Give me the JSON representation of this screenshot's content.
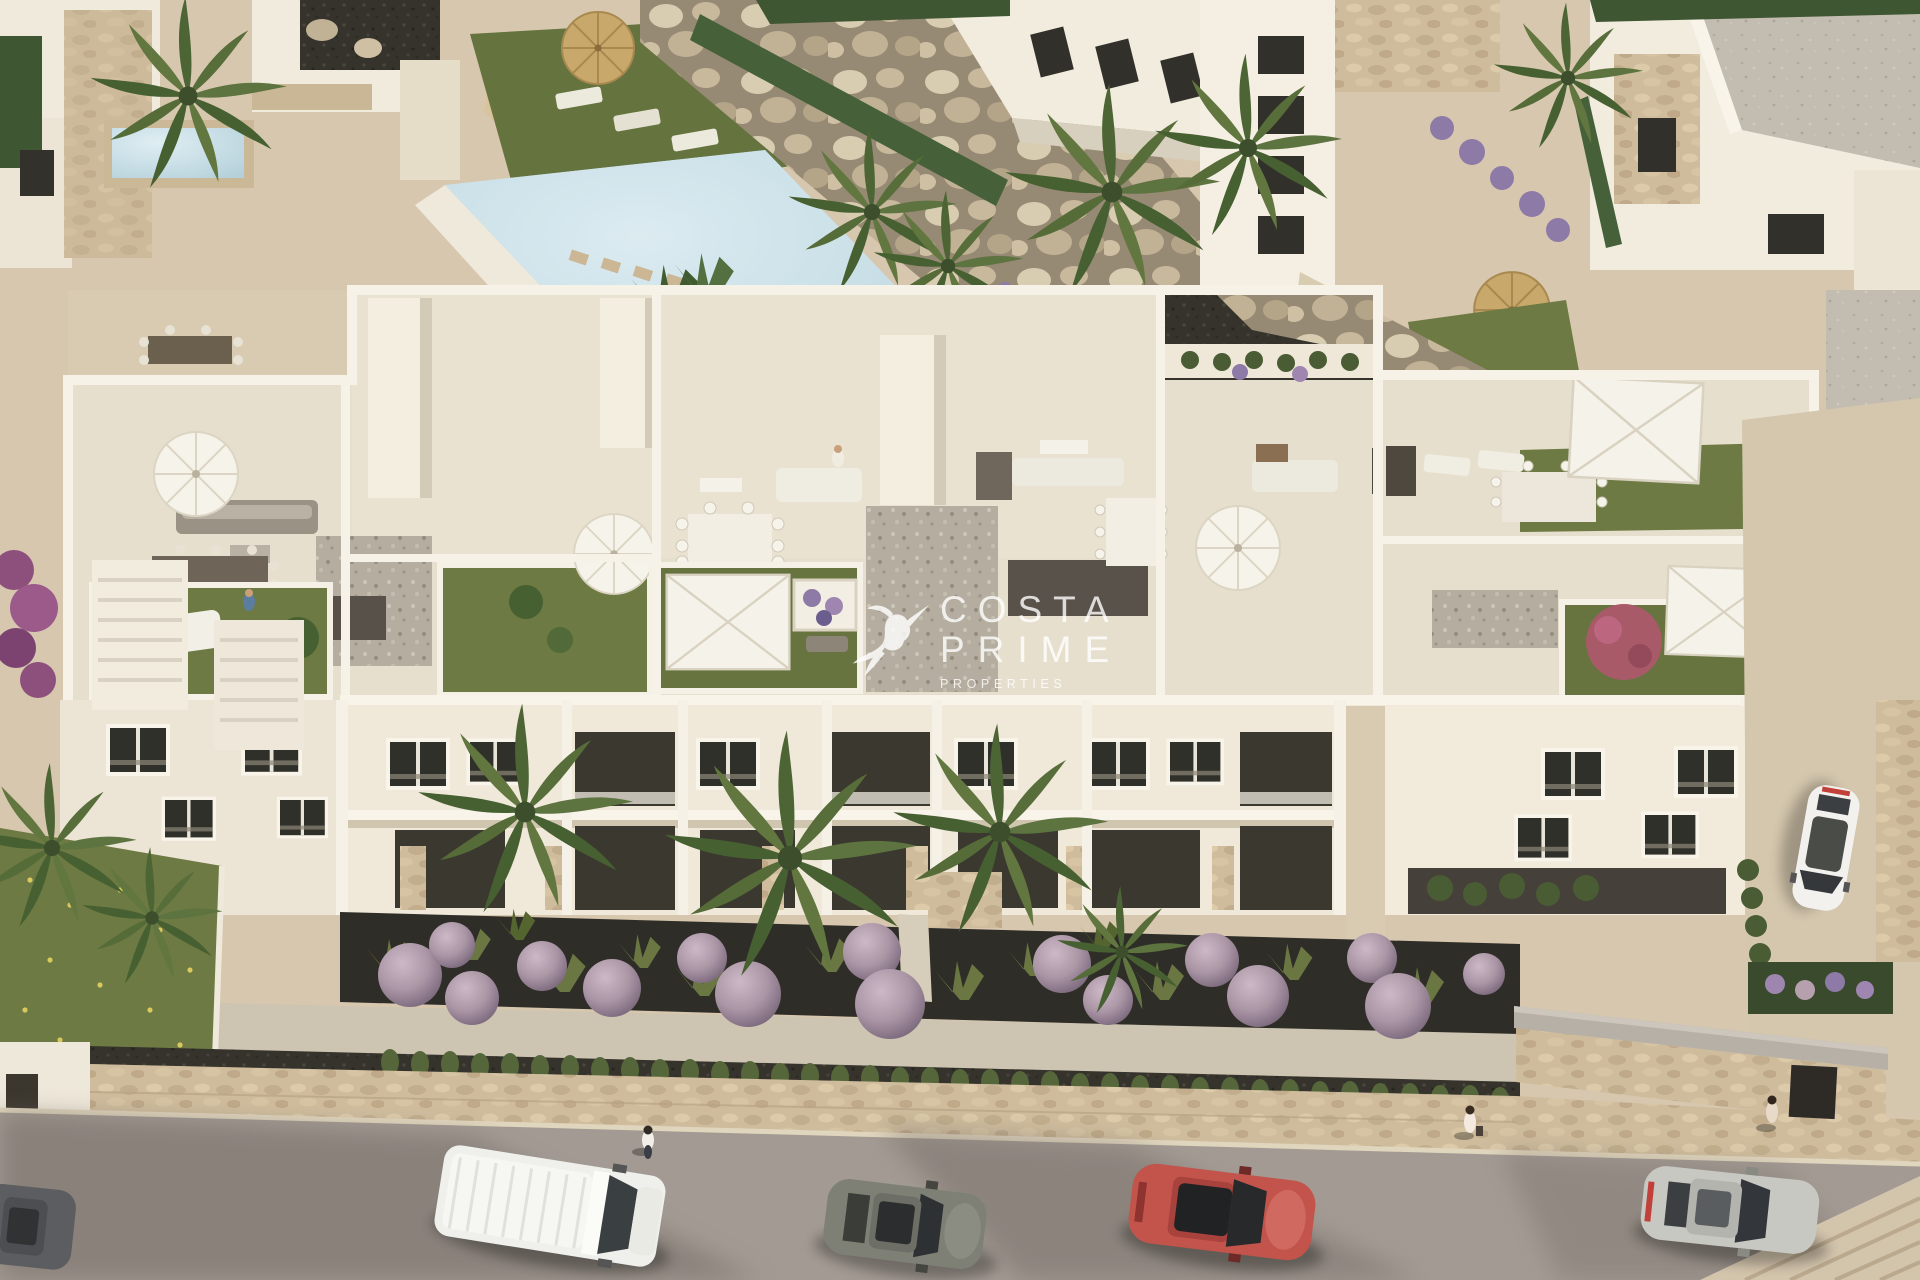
{
  "watermark": {
    "logo_icon": "hummingbird-icon",
    "line1": "COSTA",
    "line2": "PRIME",
    "line3": "PROPERTIES",
    "color": "#ffffff",
    "opacity": 0.8
  },
  "scene": {
    "type": "aerial-architectural-render",
    "palette": {
      "paving": "#d6c7ae",
      "building_white": "#f2ecdf",
      "terrace_floor": "#e7dfcd",
      "lawn": "#6d7a43",
      "road": "#a39b93",
      "soil": "#2f2d27",
      "stone": "#c9b795",
      "hedge": "#4a5c33",
      "pool": "#c6dde6",
      "mauve_bush": "#b7a0ae"
    },
    "pool": {
      "color": "#c6dde6"
    },
    "vehicles": [
      {
        "name": "white-van-street",
        "color": "#eff0ec"
      },
      {
        "name": "gray-hatchback-street",
        "color": "#7e8076"
      },
      {
        "name": "red-hatchback-street",
        "color": "#c2544c"
      },
      {
        "name": "silver-hatchback-street",
        "color": "#c8c8c3"
      },
      {
        "name": "white-car-driveway",
        "color": "#f2f1ee"
      },
      {
        "name": "dark-car-left-edge",
        "color": "#5b5d60"
      }
    ],
    "pedestrians": 5,
    "rooftop_amenities": [
      "round-parasols",
      "square-canopies",
      "outdoor-sofas",
      "dining-sets",
      "sun-loungers",
      "lawn-patches",
      "gravel-courts"
    ],
    "landscaping": [
      "fan-palms",
      "mauve-ball-shrubs",
      "ornamental-grasses",
      "cypress-hedges",
      "boulder-wall",
      "flower-planters"
    ]
  }
}
